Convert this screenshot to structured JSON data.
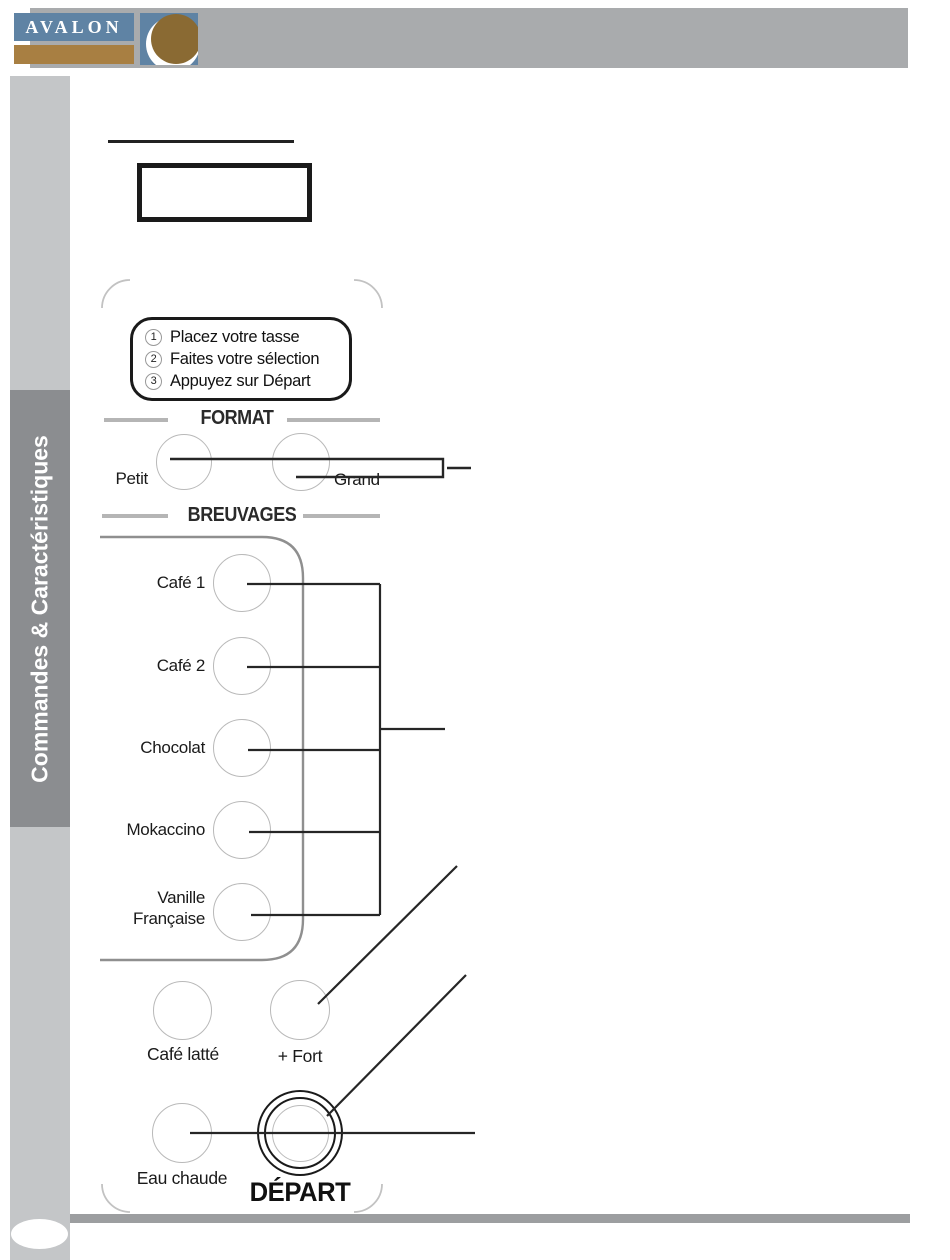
{
  "header": {
    "brand": "AVALON"
  },
  "sidebar": {
    "tab_label": "Commandes & Caractéristiques"
  },
  "panel": {
    "instructions": {
      "steps": [
        {
          "num": "1",
          "text": "Placez votre tasse"
        },
        {
          "num": "2",
          "text": "Faites votre sélection"
        },
        {
          "num": "3",
          "text": "Appuyez sur Départ"
        }
      ]
    },
    "format": {
      "heading": "FORMAT",
      "small_label": "Petit",
      "large_label": "Grand"
    },
    "beverages": {
      "heading": "BREUVAGES",
      "items": [
        {
          "label": "Café 1"
        },
        {
          "label": "Café 2"
        },
        {
          "label": "Chocolat"
        },
        {
          "label": "Mokaccino"
        },
        {
          "label_line1": "Vanille",
          "label_line2": "Française"
        }
      ]
    },
    "extra_buttons": {
      "latte_label": "Café latté",
      "stronger_label": "+ Fort",
      "hot_water_label": "Eau chaude"
    },
    "start": {
      "label": "DÉPART"
    }
  },
  "colors": {
    "header_bar": "#a9abad",
    "sidebar_strip": "#c4c6c8",
    "sidebar_tab": "#8b8d90",
    "logo_blue": "#5f83a4",
    "logo_brown": "#a87f42",
    "logo_sphere_brown": "#8a6a33",
    "callout_line": "#262626",
    "panel_outline": "#8f8f8f",
    "button_outline": "#b9b9b9"
  }
}
